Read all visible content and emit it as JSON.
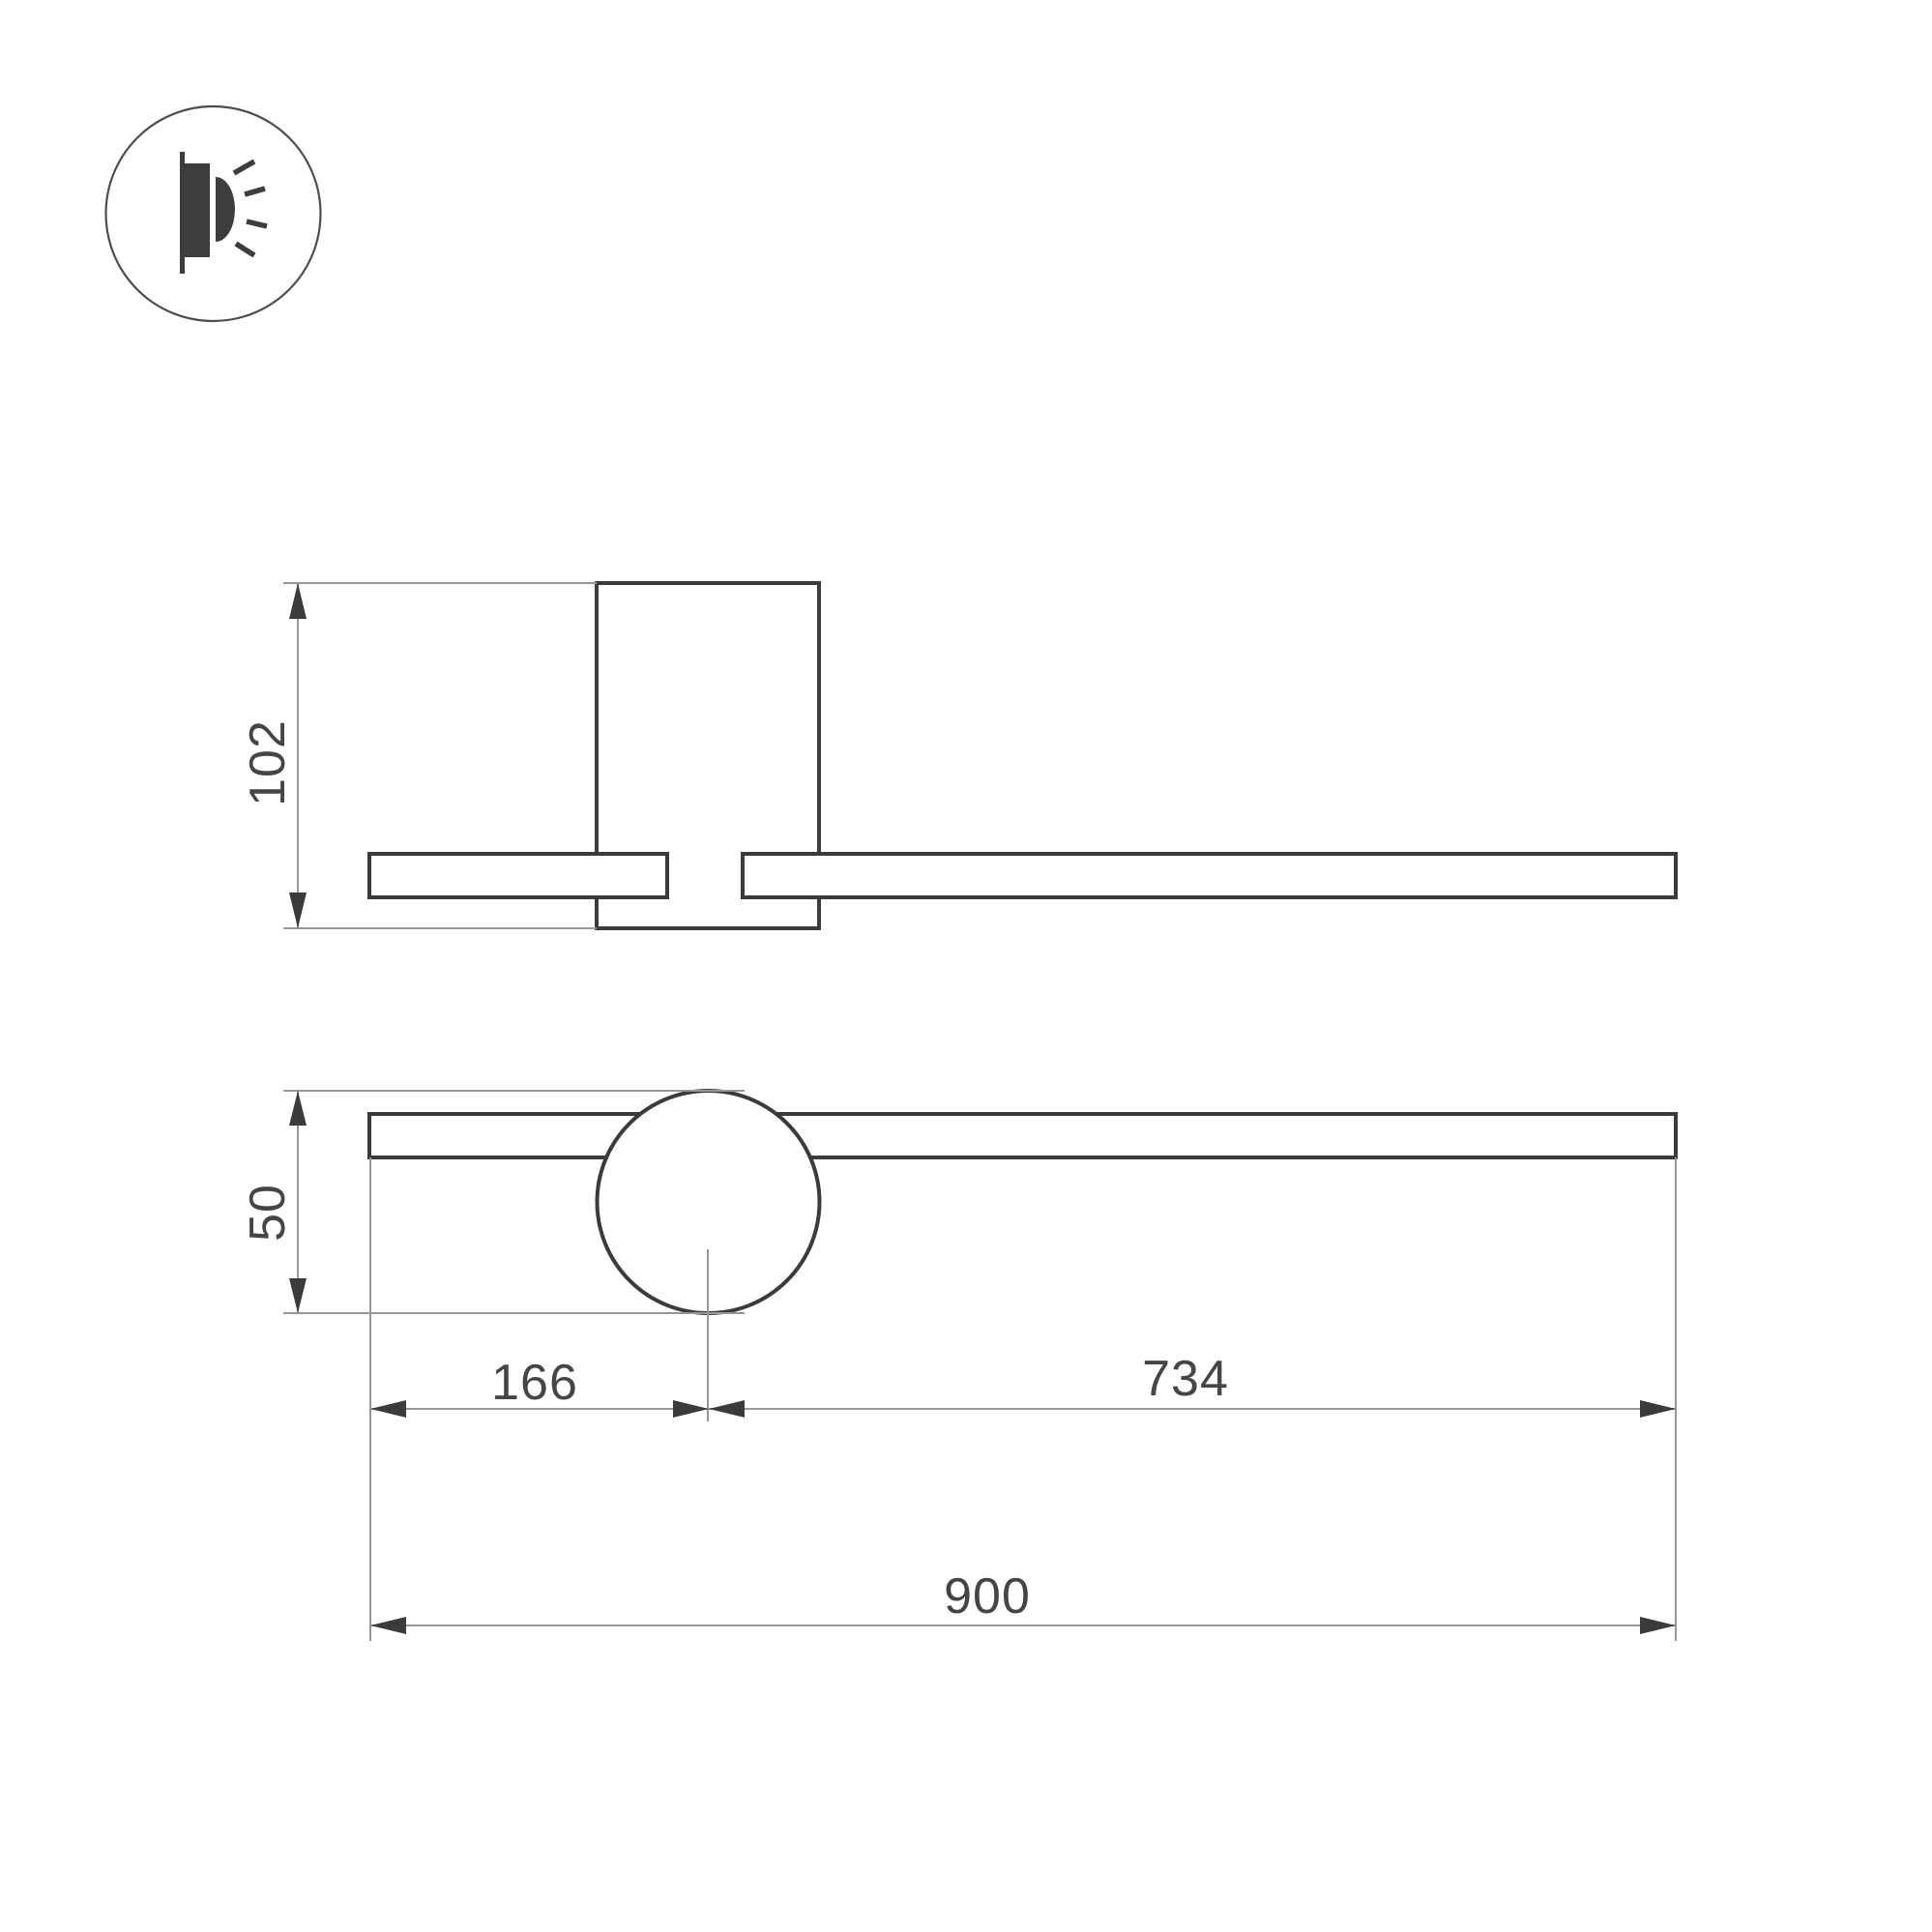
{
  "icon": {
    "name": "wall-lamp-glow-icon"
  },
  "views": {
    "side": {
      "height_dim": "102"
    },
    "front": {
      "height_dim": "50",
      "left_dim": "166",
      "right_dim": "734",
      "total_dim": "900"
    }
  },
  "colors": {
    "outline": "#3b3b3b",
    "dim_line": "#979797",
    "arrow": "#3b3b3b",
    "text": "#454545",
    "icon": "#3d3d3d",
    "background": "#ffffff"
  }
}
